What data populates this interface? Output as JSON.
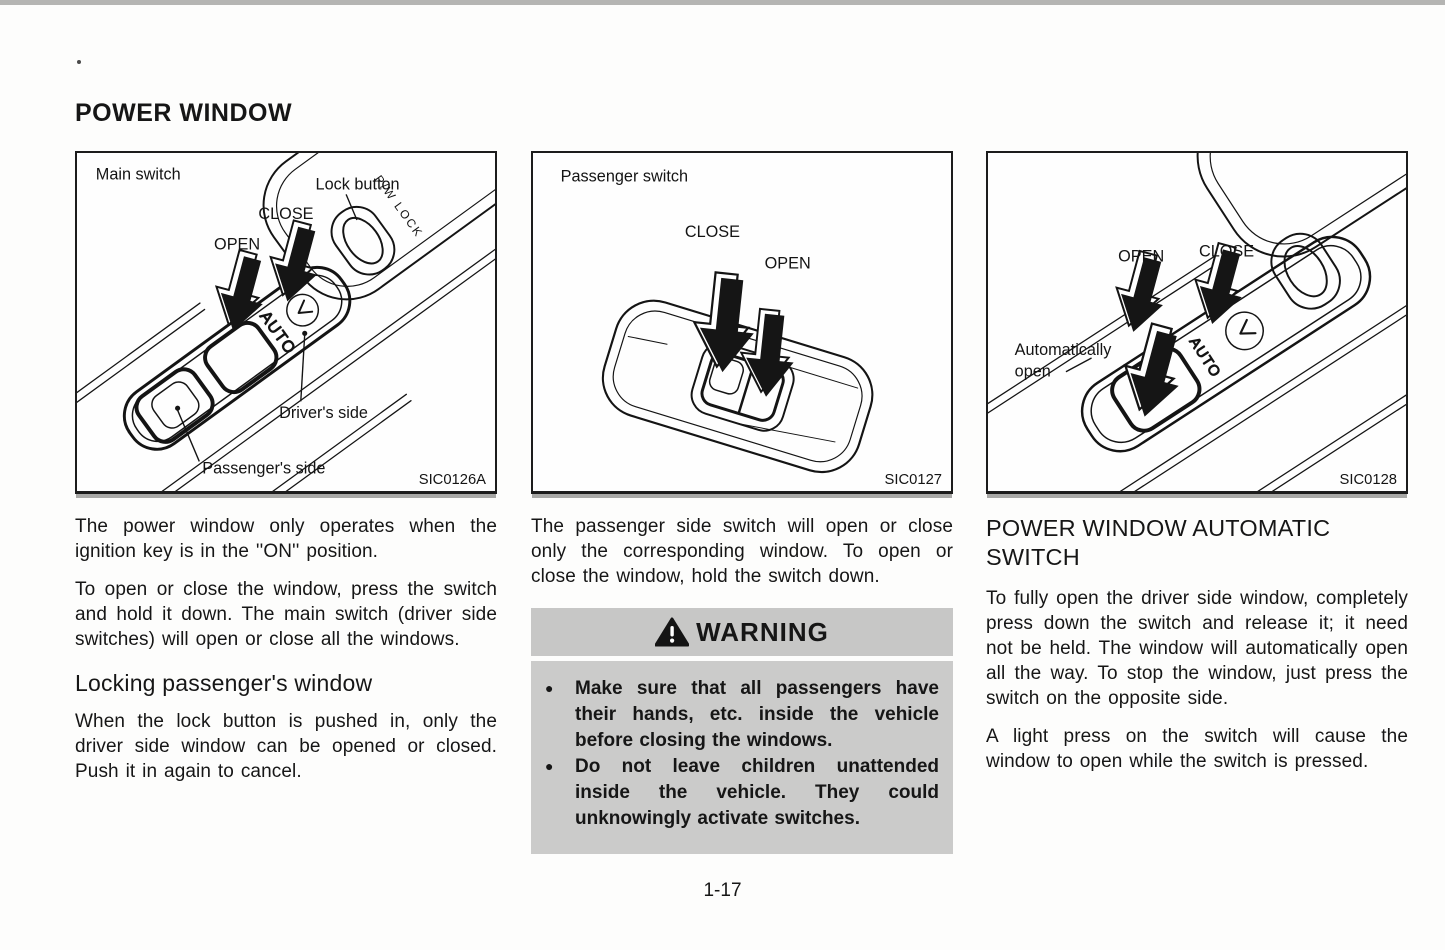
{
  "page": {
    "title": "POWER WINDOW",
    "page_number": "1-17"
  },
  "figures": [
    {
      "caption": "Main switch",
      "labels": {
        "lock_button": "Lock button",
        "close": "CLOSE",
        "open": "OPEN",
        "pw_lock": "P/W LOCK",
        "auto": "AUTO",
        "drivers_side": "Driver's side",
        "passengers_side": "Passenger's side"
      },
      "code": "SIC0126A"
    },
    {
      "caption": "Passenger switch",
      "labels": {
        "close": "CLOSE",
        "open": "OPEN"
      },
      "code": "SIC0127"
    },
    {
      "labels": {
        "open": "OPEN",
        "close": "CLOSE",
        "automatically": "Automatically",
        "open_word": "open",
        "auto": "AUTO"
      },
      "code": "SIC0128"
    }
  ],
  "columns": {
    "left": {
      "paragraph_1": "The power window only operates when the ignition key is in the ''ON'' position.",
      "paragraph_2": "To open or close the window, press the switch and hold it down. The main switch (driver side switches) will open or close all the windows.",
      "heading": "Locking passenger's window",
      "paragraph_3": "When the lock button is pushed in, only the driver side window can be opened or closed. Push it in again to cancel."
    },
    "middle": {
      "paragraph_1": "The passenger side switch will open or close only the corresponding window. To open or close the window, hold the switch down.",
      "warning": {
        "title": "WARNING",
        "items": [
          "Make sure that all passengers have their hands, etc. inside the vehicle before closing the windows.",
          "Do not leave children unattended inside the vehicle. They could unknowingly activate switches."
        ]
      }
    },
    "right": {
      "heading": "POWER WINDOW AUTOMATIC SWITCH",
      "paragraph_1": "To fully open the driver side window, completely press down the switch and release it; it need not be held. The window will automatically open all the way. To stop the window, just press the switch on the opposite side.",
      "paragraph_2": "A light press on the switch will cause the window to open while the switch is pressed."
    }
  },
  "colors": {
    "warning_header_bg": "#c7c7c6",
    "warning_body_bg": "#cbcbca",
    "ink": "#161616"
  }
}
